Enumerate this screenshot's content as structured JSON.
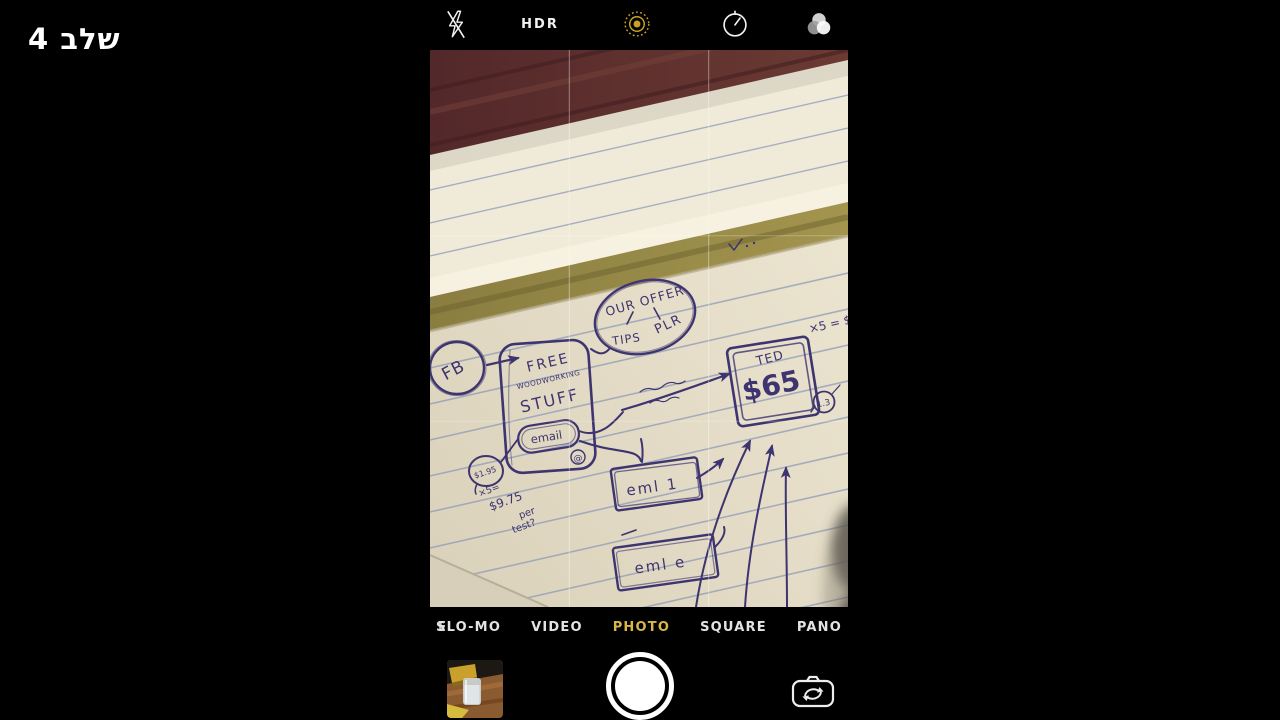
{
  "caption": "שלב 4",
  "toolbar": {
    "hdr_label": "HDR",
    "icons": {
      "flash": "flash-off",
      "live_photo": "live-photo",
      "timer": "timer",
      "filters": "filters"
    }
  },
  "viewfinder": {
    "sketch": {
      "fb": "FB",
      "free_line1": "FREE",
      "free_line2": "WOODWORKING",
      "free_line3": "STUFF",
      "email": "email",
      "at_sign": "@",
      "offer_title": "OUR OFFER",
      "offer_left": "TIPS",
      "offer_right": "PLR",
      "ted": "TED",
      "ted_price": "$65",
      "multiplier_note": "×5 = $",
      "ratio_note": "1.3",
      "seed_price": "$1.95",
      "calc_multiplier": "×5=",
      "calc_total": "$9.75",
      "calc_per": "per",
      "calc_test": "test?",
      "email_box_1": "eml 1",
      "email_box_2": "eml e"
    }
  },
  "modes": {
    "overflow_left": "E",
    "items": [
      {
        "label": "SLO-MO",
        "selected": false
      },
      {
        "label": "VIDEO",
        "selected": false
      },
      {
        "label": "PHOTO",
        "selected": true
      },
      {
        "label": "SQUARE",
        "selected": false
      },
      {
        "label": "PANO",
        "selected": false
      }
    ]
  },
  "colors": {
    "accent_yellow": "#d9b64a",
    "live_photo_yellow": "#c9a227",
    "ink": "#3d3470",
    "paper": "#e9e2cd"
  }
}
